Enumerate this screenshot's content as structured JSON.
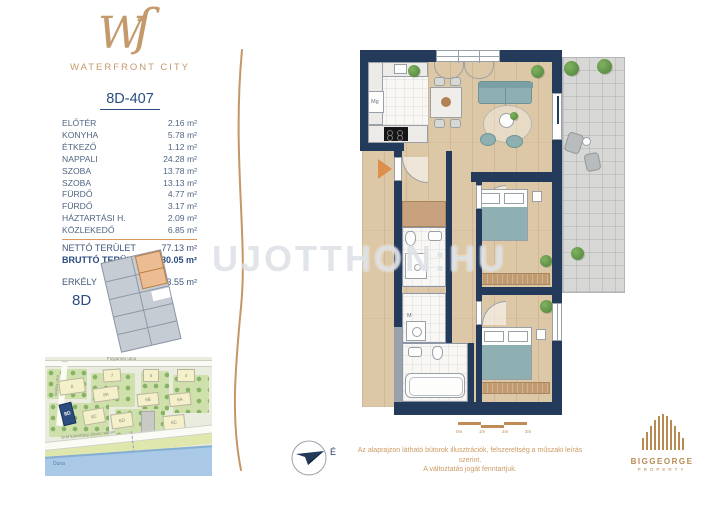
{
  "brand": {
    "monogram": "Wſ",
    "name": "WATERFRONT CITY"
  },
  "unit": {
    "id": "8D-407"
  },
  "areas": {
    "rows": [
      {
        "label": "ELŐTÉR",
        "value": "2.16 m²"
      },
      {
        "label": "KONYHA",
        "value": "5.78 m²"
      },
      {
        "label": "ÉTKEZŐ",
        "value": "1.12 m²"
      },
      {
        "label": "NAPPALI",
        "value": "24.28 m²"
      },
      {
        "label": "SZOBA",
        "value": "13.78 m²"
      },
      {
        "label": "SZOBA",
        "value": "13.13 m²"
      },
      {
        "label": "FÜRDŐ",
        "value": "4.77 m²"
      },
      {
        "label": "FÜRDŐ",
        "value": "3.17 m²"
      },
      {
        "label": "HÁZTARTÁSI H.",
        "value": "2.09 m²"
      },
      {
        "label": "KÖZLEKEDŐ",
        "value": "6.85 m²"
      }
    ],
    "netto": {
      "label": "NETTÓ TERÜLET",
      "value": "77.13 m²"
    },
    "brutto": {
      "label": "BRUTTÓ TERÜLET",
      "value": "80.05 m²"
    },
    "erkely": {
      "label": "ERKÉLY",
      "value": "13.55 m²"
    }
  },
  "keyplan": {
    "label": "8D"
  },
  "plan": {
    "dishwasher_label": "Mg",
    "washer_label": "M"
  },
  "watermark": "UJOTTHON:HU",
  "map": {
    "street_top": "Folyamőr utca",
    "street_left": "Matróz utca",
    "embankment": "Gróf Esterházy János rakpart",
    "river": "Duna",
    "buildings": [
      "7",
      "5",
      "4",
      "8",
      "8A",
      "6B",
      "6A",
      "8D",
      "8C",
      "6D",
      "6C"
    ]
  },
  "footer": {
    "north": "É",
    "scale_ticks": [
      "0m",
      "1m",
      "2m",
      "3m"
    ],
    "disclaimer_line1": "Az alaprajzon látható bútorok illusztrációk, felszereltség a műszaki leírás szerint.",
    "disclaimer_line2": "A változtatás jogát fenntartjuk.",
    "developer": "BIGGEORGE",
    "developer_sub": "PROPERTY"
  },
  "colors": {
    "brand_gold": "#c49a6c",
    "wall_navy": "#243a5b",
    "accent_blue": "#2b4d80"
  }
}
